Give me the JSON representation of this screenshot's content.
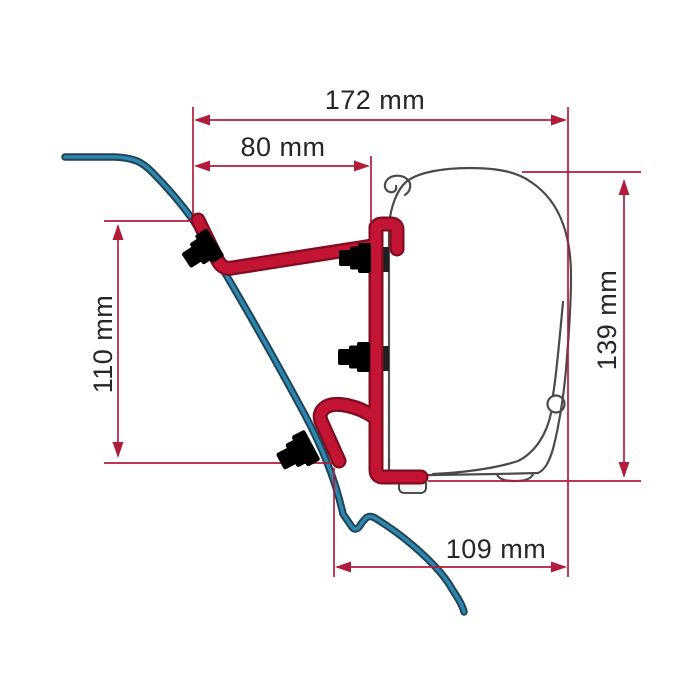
{
  "diagram": {
    "kind": "awning-adapter-bracket-dimension-drawing",
    "dimensions": {
      "top_width": {
        "label": "172 mm"
      },
      "upper_width": {
        "label": "80 mm"
      },
      "left_height": {
        "label": "110 mm"
      },
      "right_height": {
        "label": "139 mm"
      },
      "bottom_width": {
        "label": "109 mm"
      }
    },
    "colors": {
      "dimension_line": "#b01c3c",
      "bracket_red": "#c41434",
      "bracket_red_dark": "#7f0c20",
      "wall_blue": "#2f85ac",
      "wall_blue_dark": "#1d4356",
      "outline_gray": "#4a4a4a",
      "text": "#262626"
    }
  }
}
